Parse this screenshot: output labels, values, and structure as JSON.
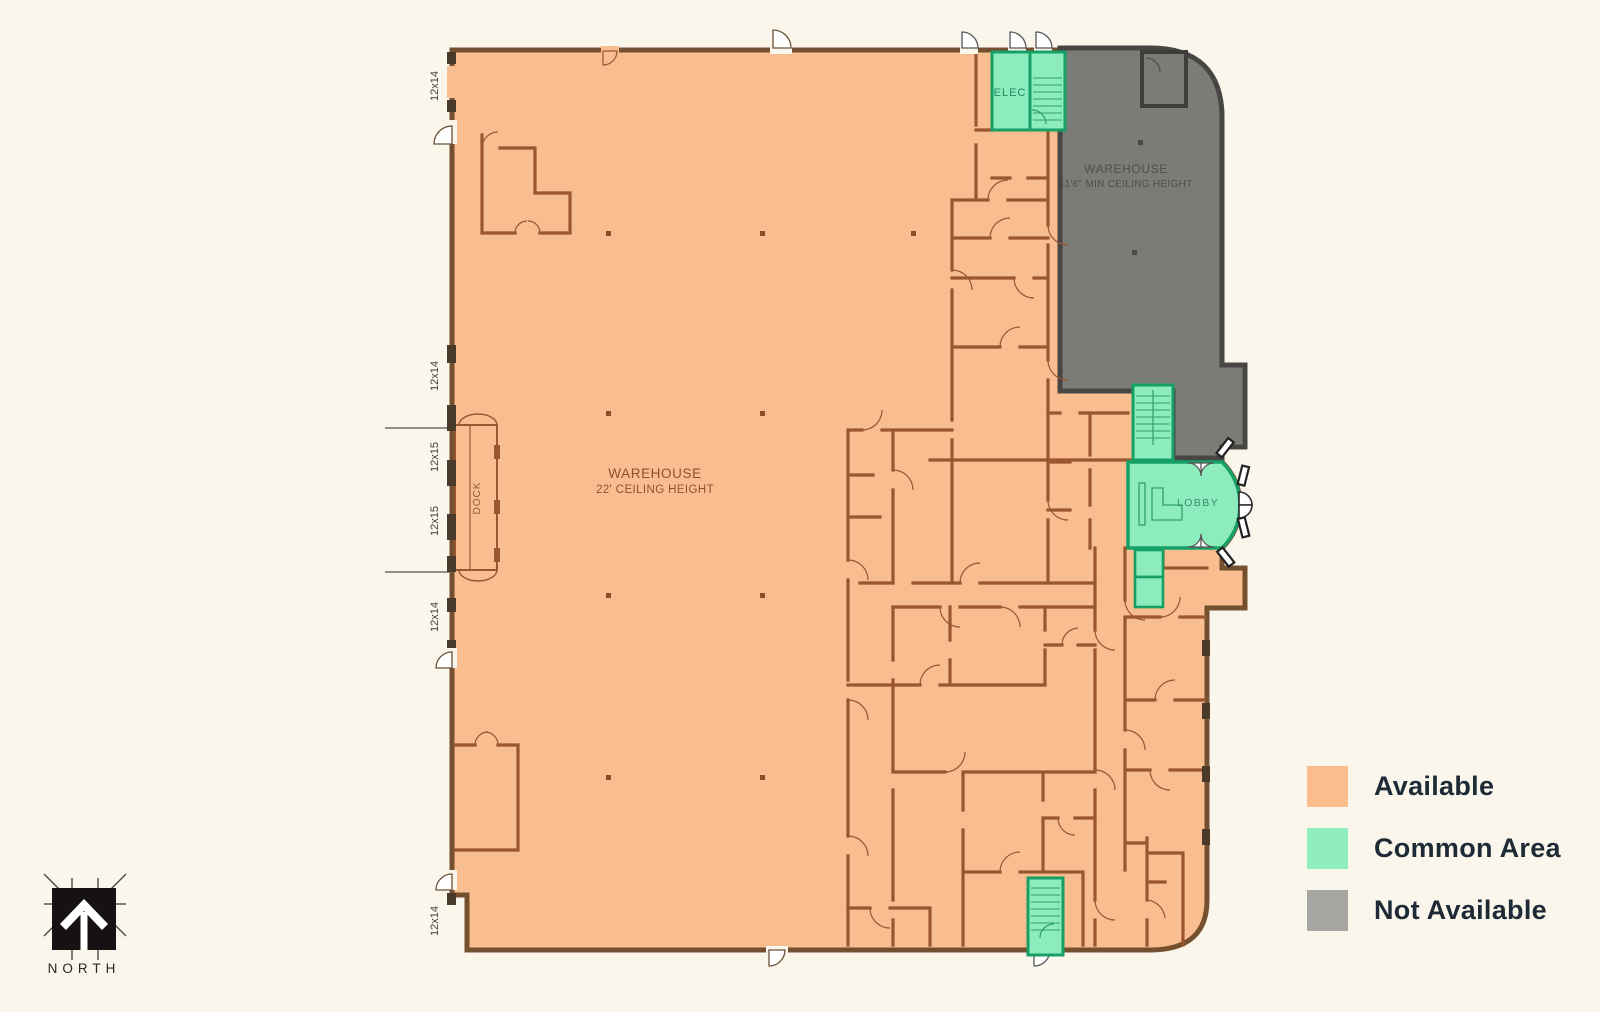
{
  "plan": {
    "warehouse_main": {
      "line1": "WAREHOUSE",
      "line2": "22' CEILING HEIGHT"
    },
    "warehouse_not_available": {
      "line1": "WAREHOUSE",
      "line2": "11'6\"  MIN CEILING HEIGHT"
    },
    "rooms": {
      "elec": "ELEC",
      "lobby": "LOBBY",
      "dock": "DOCK"
    },
    "dock_door_labels": [
      "12x14",
      "12x14",
      "12x15",
      "12x15",
      "12x14",
      "12x14"
    ]
  },
  "north_arrow": {
    "label": "NORTH"
  },
  "legend": {
    "items": [
      {
        "label": "Available",
        "color": "#FBBD8D"
      },
      {
        "label": "Common Area",
        "color": "#8FEDBE"
      },
      {
        "label": "Not Available",
        "color": "#A6A6A3"
      }
    ]
  },
  "colors": {
    "available_fill": "#F9BE8F",
    "common_fill": "#8DECBE",
    "not_available_fill": "#7B7B78",
    "wall_brown": "#9A5630",
    "wall_dark": "#474643",
    "wall_teal": "#17A066",
    "background": "#FAF6EC"
  }
}
